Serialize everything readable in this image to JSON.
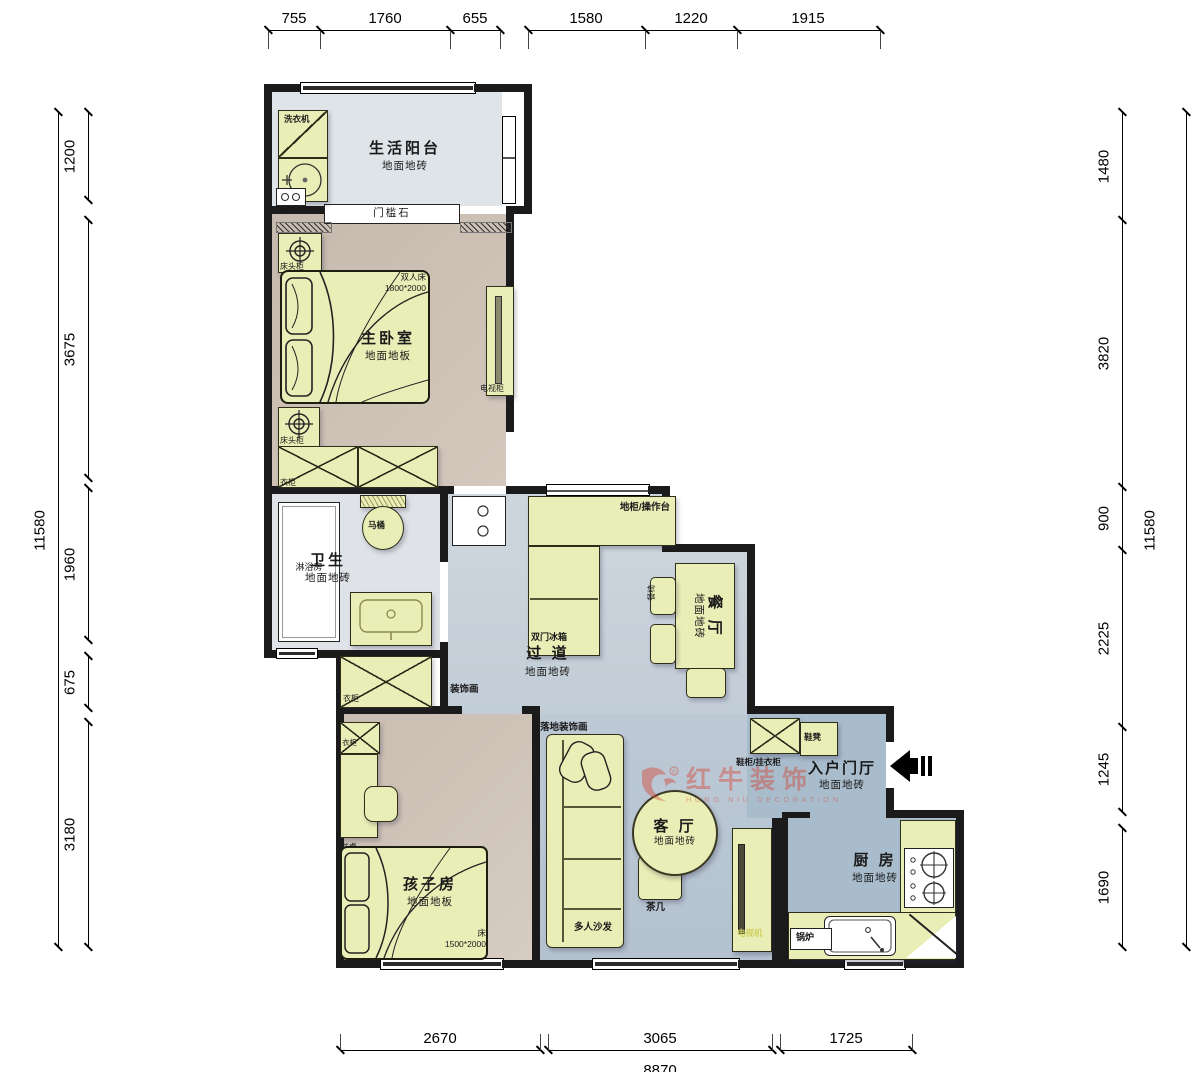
{
  "dimensions": {
    "top": [
      "755",
      "1760",
      "655",
      "1580",
      "1220",
      "1915"
    ],
    "left": [
      "1200",
      "3675",
      "1960",
      "675",
      "3180"
    ],
    "left_total": "11580",
    "right": [
      "1480",
      "3820",
      "900",
      "2225",
      "1245",
      "1690"
    ],
    "right_total": "11580",
    "bottom": [
      "2670",
      "3065",
      "1725"
    ],
    "bottom_total_partial": "8870"
  },
  "rooms": {
    "balcony": {
      "name": "生活阳台",
      "floor": "地面地砖"
    },
    "master": {
      "name": "主卧室",
      "floor": "地面地板"
    },
    "bathroom": {
      "name": "卫生",
      "floor": "地面地砖"
    },
    "hallway": {
      "name": "过 道",
      "floor": "地面地砖"
    },
    "dining": {
      "name": "餐 厅",
      "floor": "地面地砖"
    },
    "living": {
      "name": "客 厅",
      "floor": "地面地砖"
    },
    "entry": {
      "name": "入户门厅",
      "floor": "地面地砖"
    },
    "kitchen": {
      "name": "厨 房",
      "floor": "地面地砖"
    },
    "kids": {
      "name": "孩子房",
      "floor": "地面地板"
    }
  },
  "furniture": {
    "washing_machine": "洗衣机",
    "threshold": "门槛石",
    "nightstand": "床头柜",
    "double_bed": "双人床",
    "double_bed_size": "1800*2000",
    "wardrobe": "衣柜",
    "tv_cabinet": "电视柜",
    "shower": "淋浴房",
    "toilet": "马桶",
    "counter": "地柜/操作台",
    "fridge": "双门冰箱",
    "dining_chair": "餐椅",
    "art": "装饰画",
    "floor_art": "落地装饰画",
    "shoe_cabinet": "鞋柜/挂衣柜",
    "shoe_bench": "鞋凳",
    "sofa": "多人沙发",
    "tea_table": "茶几",
    "tv": "电视机",
    "boiler": "锅炉",
    "desk": "书桌",
    "kids_bed": "床",
    "kids_bed_size": "1500*2000"
  },
  "brand": {
    "name": "红牛装饰",
    "sub": "HONG NIU DECORATION"
  },
  "colors": {
    "wall": "#1b1b1b",
    "furniture_fill": "#e9eeb6",
    "balcony_floor": "#dfe4e8",
    "bedroom_floor": "#c9bcb0",
    "bath_floor": "#dfe3e7",
    "hall_floor": "#c8d1da",
    "living_floor": "#bcc8d4",
    "entry_kitchen_floor": "#a8bccc",
    "kids_floor": "#cfc3b7",
    "brand_red": "#d5402e"
  }
}
